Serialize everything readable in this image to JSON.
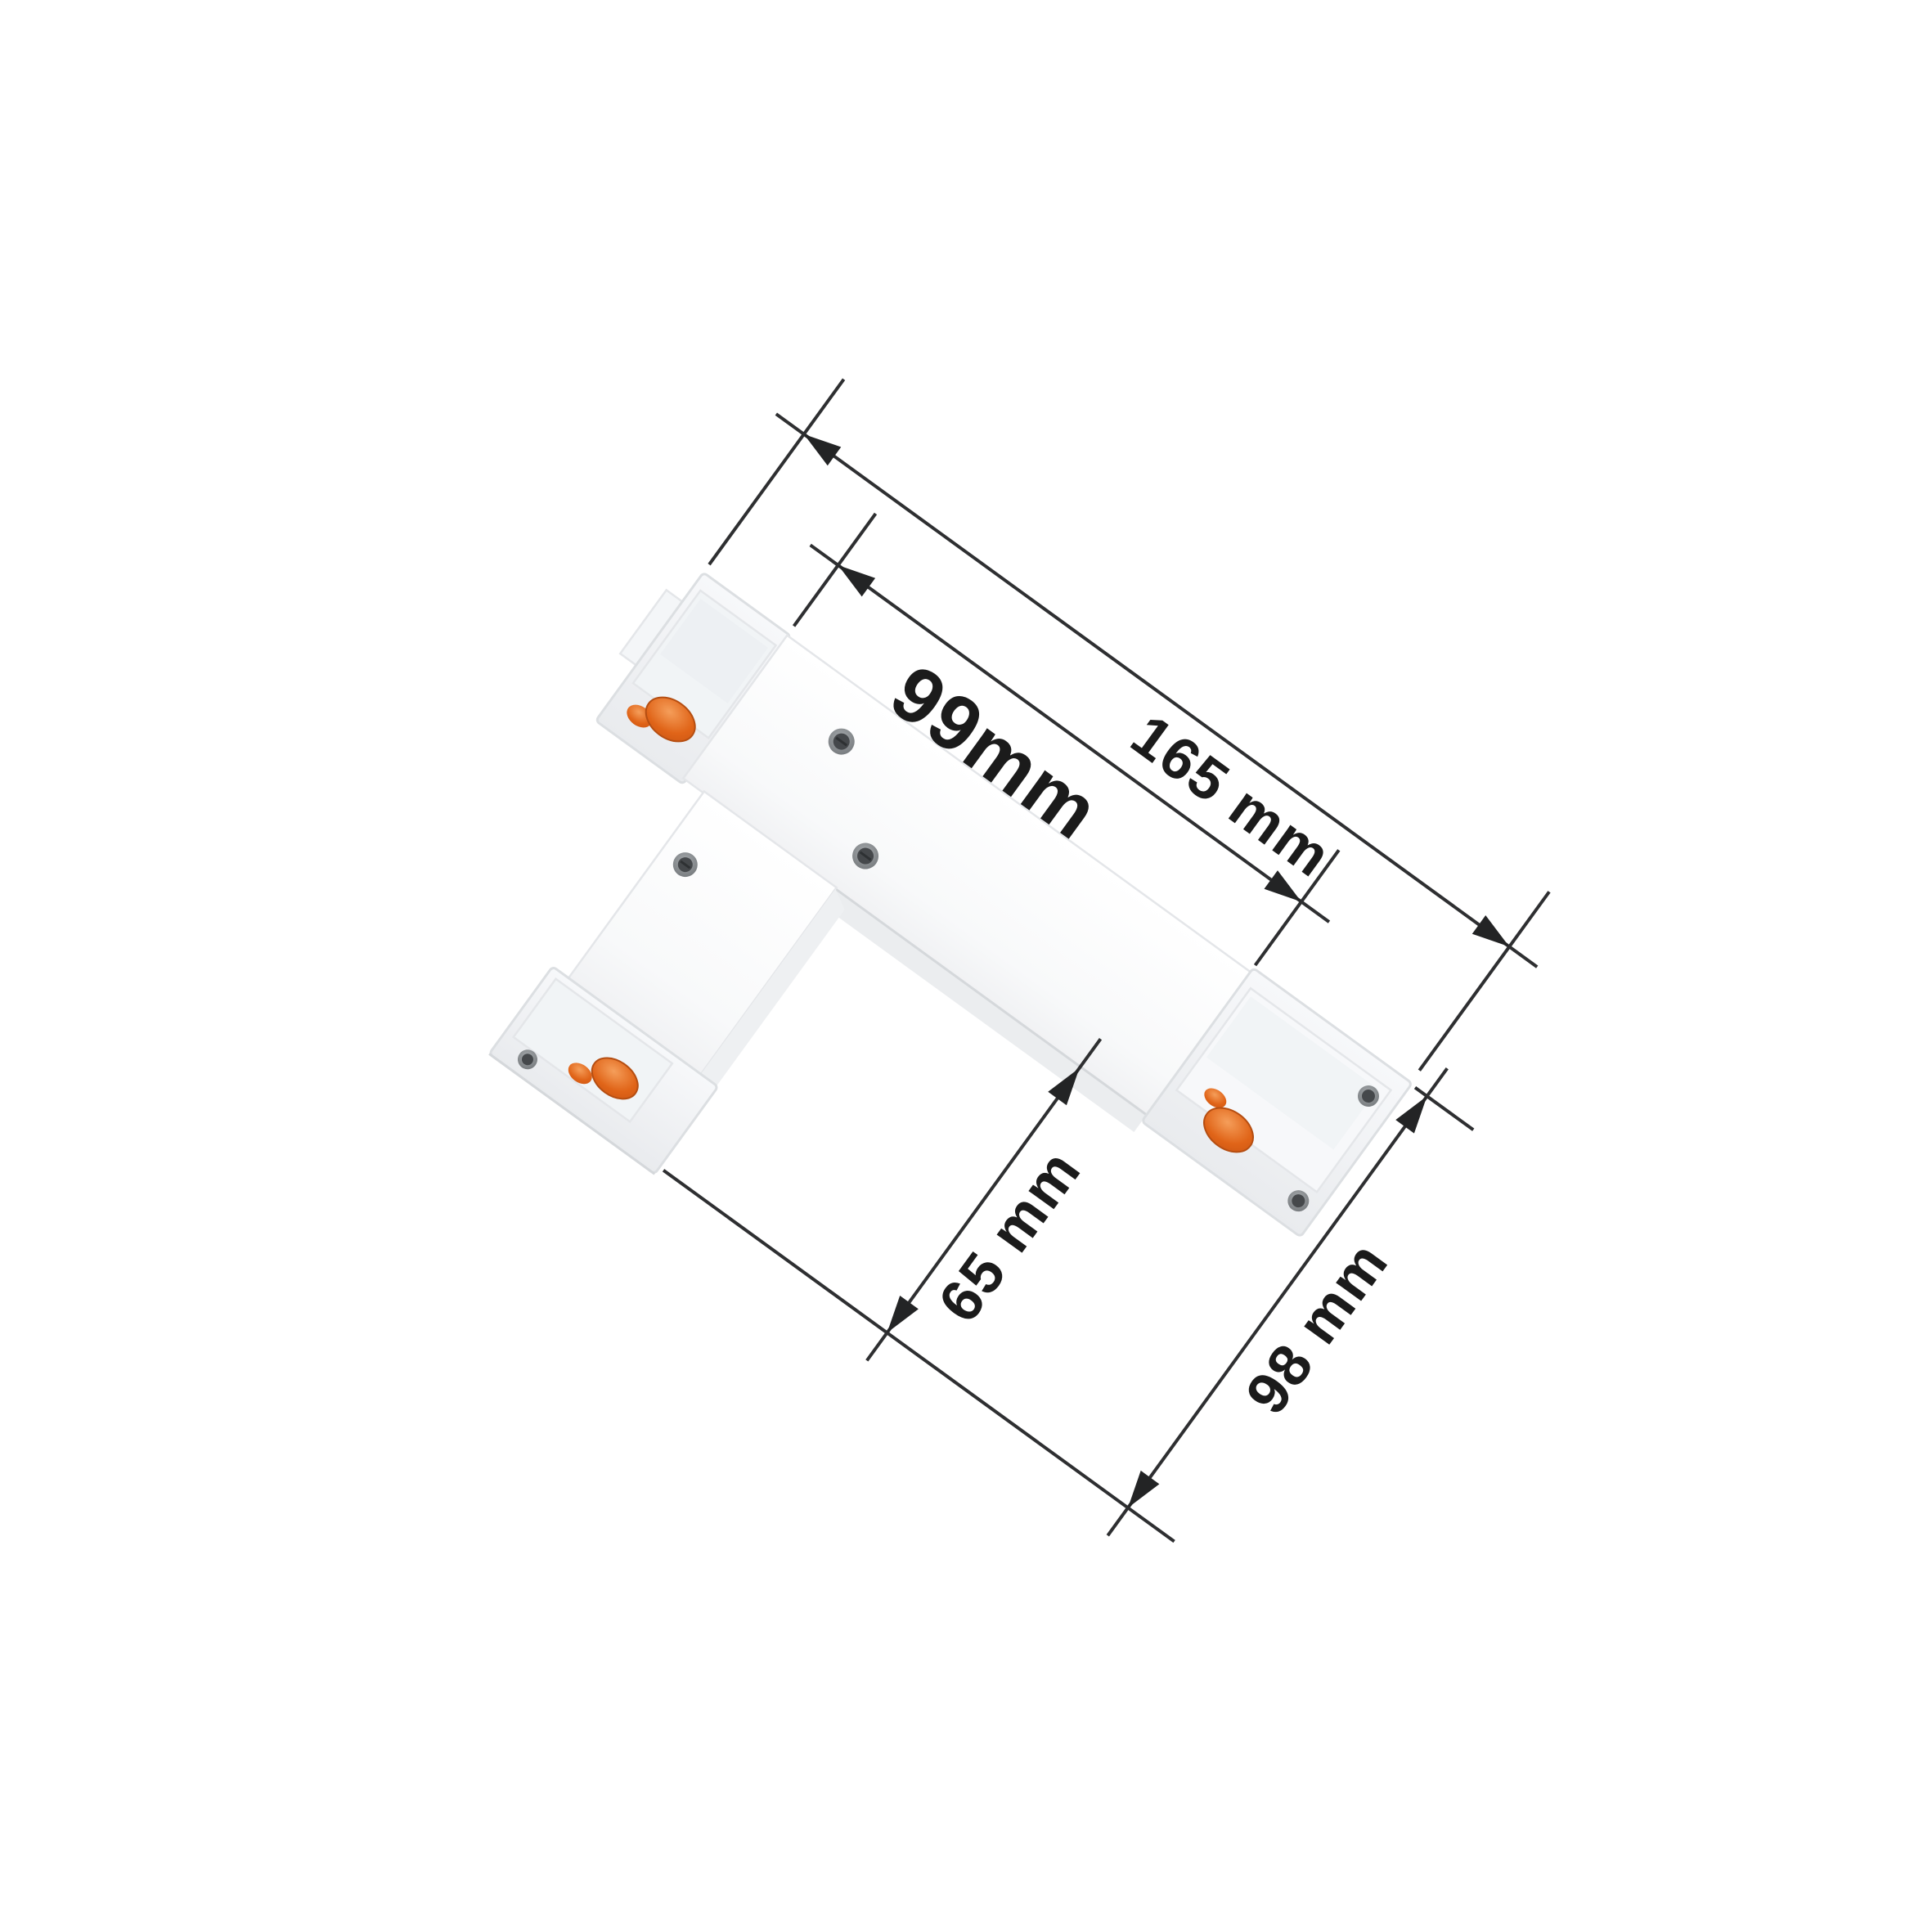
{
  "figure": {
    "type": "product dimension diagram",
    "subject": "White T-shaped track lighting connector shown at an angle with measurement callouts",
    "background": "#ffffff"
  },
  "dimensions": {
    "total_length": "165 mm",
    "body_length": "99mm",
    "stem_depth": "65 mm",
    "total_width": "98 mm"
  },
  "colors": {
    "dimension_line": "#2e2f31",
    "label_text": "#1b1b1b",
    "connector_body": "#fbfcfd",
    "end_cap_gray": "#eef0f3",
    "contact_orange": "#e06418",
    "screw_dark": "#45484b",
    "background": "#ffffff"
  }
}
